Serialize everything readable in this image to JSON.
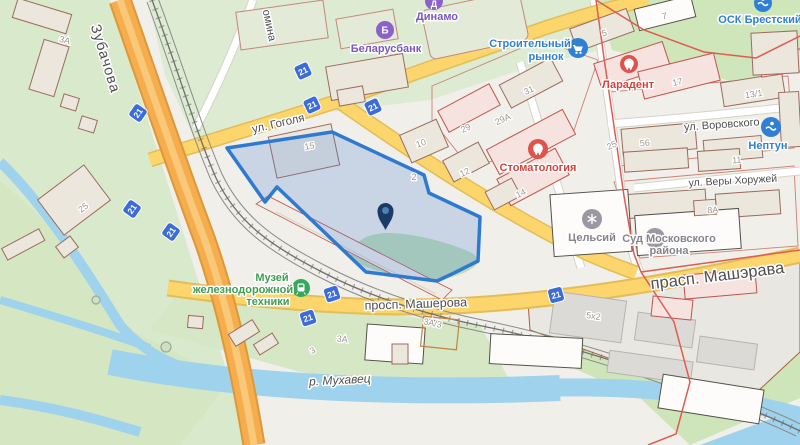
{
  "streets": {
    "zubachova": "Зубачова",
    "omina_partial": "омина",
    "gogolya": "ул. Гоголя",
    "vorovskogo": "ул. Воровского",
    "very_khoruzhey": "ул. Веры Хоружей",
    "masherova": "просп. Машерова",
    "masherava_large": "прасп. Машэрава",
    "river": "р. Мухавец"
  },
  "pois": {
    "dinamo": {
      "label": "Динамо",
      "color": "#7a57bd",
      "icon_letter": "Д"
    },
    "belarusbank": {
      "label": "Беларусбанк",
      "color": "#7a57bd",
      "icon_letter": "Б"
    },
    "stroitelny_rynok": {
      "label_line1": "Строительный",
      "label_line2": "рынок",
      "color": "#2f80d4"
    },
    "osk_brestsky": {
      "label": "ОСК Брестский",
      "color": "#2f80d4"
    },
    "laradent": {
      "label": "Ларадент",
      "color": "#d6433d"
    },
    "stomatologia": {
      "label": "Стоматология",
      "color": "#d6433d"
    },
    "neptun": {
      "label": "Нептун",
      "color": "#2f80d4"
    },
    "celsiy": {
      "label": "Цельсий",
      "color": "#85848c"
    },
    "sud": {
      "label_line1": "Суд Московского",
      "label_line2": "района",
      "color": "#85848c"
    },
    "museum": {
      "label_line1": "Музей",
      "label_line2": "железнодорожной",
      "label_line3": "техники",
      "color": "#3f9e52"
    }
  },
  "road_badge": {
    "label": "21",
    "color": "#3c6cd7",
    "count_visible": 9
  },
  "building_numbers": [
    {
      "text": "3А"
    },
    {
      "text": "25"
    },
    {
      "text": "15"
    },
    {
      "text": "2"
    },
    {
      "text": "10"
    },
    {
      "text": "29"
    },
    {
      "text": "12"
    },
    {
      "text": "29А"
    },
    {
      "text": "31"
    },
    {
      "text": "5"
    },
    {
      "text": "7"
    },
    {
      "text": "17"
    },
    {
      "text": "13/1"
    },
    {
      "text": "25"
    },
    {
      "text": "56"
    },
    {
      "text": "11"
    },
    {
      "text": "14"
    },
    {
      "text": "8А"
    },
    {
      "text": "3А"
    },
    {
      "text": "3А/3"
    },
    {
      "text": "3"
    },
    {
      "text": "5х2"
    }
  ],
  "selection": {
    "stroke": "#2f7ad1",
    "fill": "rgba(58,125,216,0.22)"
  },
  "pin": {
    "body_color": "#1c3a66",
    "dot_color": "#4e81b0"
  },
  "colors": {
    "background": "#f1efe9",
    "green_area": "#d2e6bf",
    "water": "#9fd2ec",
    "road_major": "#f5ad4d",
    "road_secondary": "#fcd66d",
    "railway": "#6e6e6e",
    "district_boundary": "#e05b50"
  }
}
